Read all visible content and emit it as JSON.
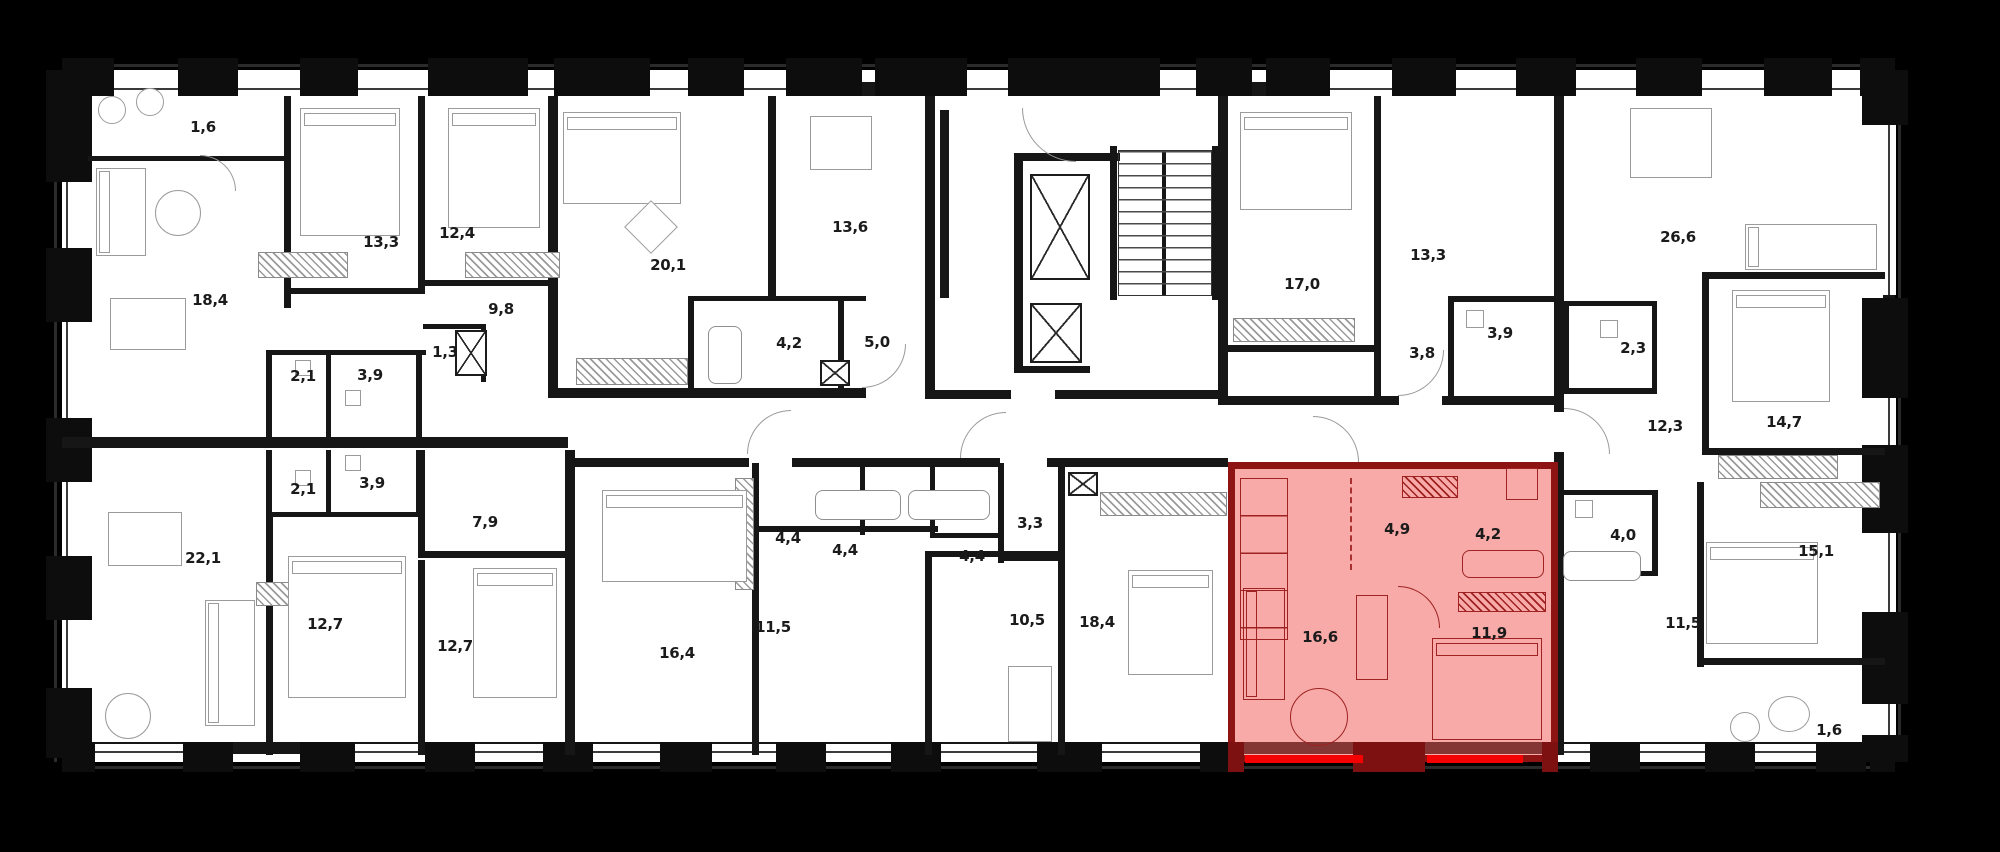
{
  "plan": {
    "title": "residential floor plan",
    "highlight": {
      "fill_rgba": "rgba(240,85,80,0.5)",
      "border": "#8e1414",
      "underline": "#f50000"
    },
    "rooms": [
      {
        "label": "1,6",
        "x": 203,
        "y": 127,
        "highlighted": false
      },
      {
        "label": "13,3",
        "x": 381,
        "y": 242,
        "highlighted": false
      },
      {
        "label": "12,4",
        "x": 457,
        "y": 233,
        "highlighted": false
      },
      {
        "label": "18,4",
        "x": 210,
        "y": 300,
        "highlighted": false
      },
      {
        "label": "9,8",
        "x": 501,
        "y": 309,
        "highlighted": false
      },
      {
        "label": "1,3",
        "x": 445,
        "y": 352,
        "highlighted": false
      },
      {
        "label": "2,1",
        "x": 303,
        "y": 376,
        "highlighted": false
      },
      {
        "label": "3,9",
        "x": 370,
        "y": 375,
        "highlighted": false
      },
      {
        "label": "20,1",
        "x": 668,
        "y": 265,
        "highlighted": false
      },
      {
        "label": "13,6",
        "x": 850,
        "y": 227,
        "highlighted": false
      },
      {
        "label": "4,2",
        "x": 789,
        "y": 343,
        "highlighted": false
      },
      {
        "label": "5,0",
        "x": 877,
        "y": 342,
        "highlighted": false
      },
      {
        "label": "17,0",
        "x": 1302,
        "y": 284,
        "highlighted": false
      },
      {
        "label": "13,3",
        "x": 1428,
        "y": 255,
        "highlighted": false
      },
      {
        "label": "3,9",
        "x": 1500,
        "y": 333,
        "highlighted": false
      },
      {
        "label": "3,8",
        "x": 1422,
        "y": 353,
        "highlighted": false
      },
      {
        "label": "26,6",
        "x": 1678,
        "y": 237,
        "highlighted": false
      },
      {
        "label": "2,3",
        "x": 1633,
        "y": 348,
        "highlighted": false
      },
      {
        "label": "12,3",
        "x": 1665,
        "y": 426,
        "highlighted": false
      },
      {
        "label": "14,7",
        "x": 1784,
        "y": 422,
        "highlighted": false
      },
      {
        "label": "2,1",
        "x": 303,
        "y": 489,
        "highlighted": false
      },
      {
        "label": "3,9",
        "x": 372,
        "y": 483,
        "highlighted": false
      },
      {
        "label": "22,1",
        "x": 203,
        "y": 558,
        "highlighted": false
      },
      {
        "label": "7,9",
        "x": 485,
        "y": 522,
        "highlighted": false
      },
      {
        "label": "12,7",
        "x": 325,
        "y": 624,
        "highlighted": false
      },
      {
        "label": "12,7",
        "x": 455,
        "y": 646,
        "highlighted": false
      },
      {
        "label": "16,4",
        "x": 677,
        "y": 653,
        "highlighted": false
      },
      {
        "label": "11,5",
        "x": 773,
        "y": 627,
        "highlighted": false
      },
      {
        "label": "4,4",
        "x": 788,
        "y": 538,
        "highlighted": false
      },
      {
        "label": "4,4",
        "x": 845,
        "y": 550,
        "highlighted": false
      },
      {
        "label": "4,4",
        "x": 972,
        "y": 556,
        "highlighted": false
      },
      {
        "label": "3,3",
        "x": 1030,
        "y": 523,
        "highlighted": false
      },
      {
        "label": "10,5",
        "x": 1027,
        "y": 620,
        "highlighted": false
      },
      {
        "label": "18,4",
        "x": 1097,
        "y": 622,
        "highlighted": false
      },
      {
        "label": "4,9",
        "x": 1397,
        "y": 529,
        "highlighted": true
      },
      {
        "label": "4,2",
        "x": 1488,
        "y": 534,
        "highlighted": true
      },
      {
        "label": "16,6",
        "x": 1320,
        "y": 637,
        "highlighted": true
      },
      {
        "label": "11,9",
        "x": 1489,
        "y": 633,
        "highlighted": true
      },
      {
        "label": "4,0",
        "x": 1623,
        "y": 535,
        "highlighted": false
      },
      {
        "label": "11,5",
        "x": 1683,
        "y": 623,
        "highlighted": false
      },
      {
        "label": "15,1",
        "x": 1816,
        "y": 551,
        "highlighted": false
      },
      {
        "label": "1,6",
        "x": 1829,
        "y": 730,
        "highlighted": false
      }
    ]
  }
}
